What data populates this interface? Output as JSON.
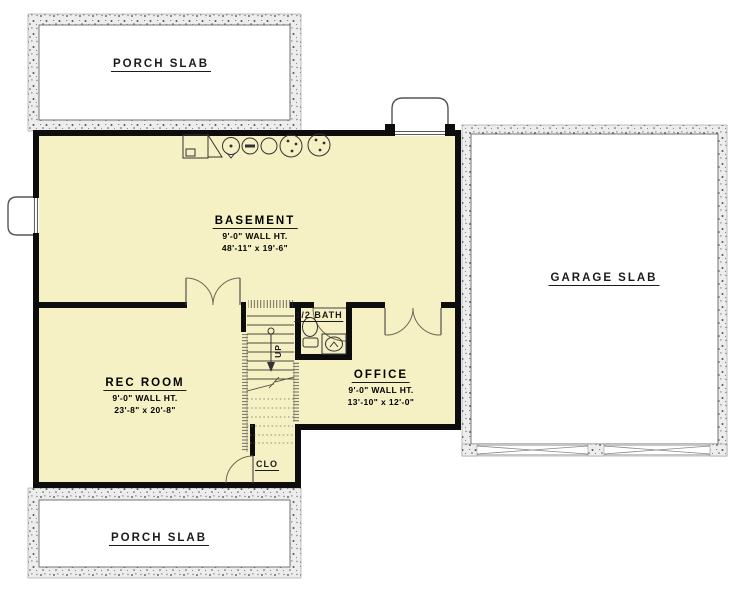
{
  "plan": {
    "type": "basement-floor-plan",
    "areas": {
      "porch_top": "PORCH SLAB",
      "porch_bottom": "PORCH SLAB",
      "garage": "GARAGE SLAB"
    },
    "rooms": {
      "basement": {
        "name": "BASEMENT",
        "wall_height": "9'-0\" WALL HT.",
        "dimensions": "48'-11\" x 19'-6\""
      },
      "rec_room": {
        "name": "REC ROOM",
        "wall_height": "9'-0\" WALL HT.",
        "dimensions": "23'-8\" x 20'-8\""
      },
      "office": {
        "name": "OFFICE",
        "wall_height": "9'-0\" WALL HT.",
        "dimensions": "13'-10\" x 12'-0\""
      },
      "half_bath": {
        "name": "1/2 BATH"
      },
      "closet": {
        "name": "CLO"
      }
    },
    "stairs": {
      "direction": "UP"
    },
    "icons": [
      "furnace-icon",
      "water-heater-icon",
      "drain-circle-icon",
      "plain-circle-icon",
      "sump-pit-icon",
      "sump-pit-icon",
      "toilet-icon",
      "sink-icon",
      "window-well-icon",
      "window-well-icon"
    ],
    "colors": {
      "floor": "#F6F1C4",
      "wall": "#0d0d0d",
      "concrete": "#EDEDED",
      "line": "#4a4a3c"
    }
  }
}
